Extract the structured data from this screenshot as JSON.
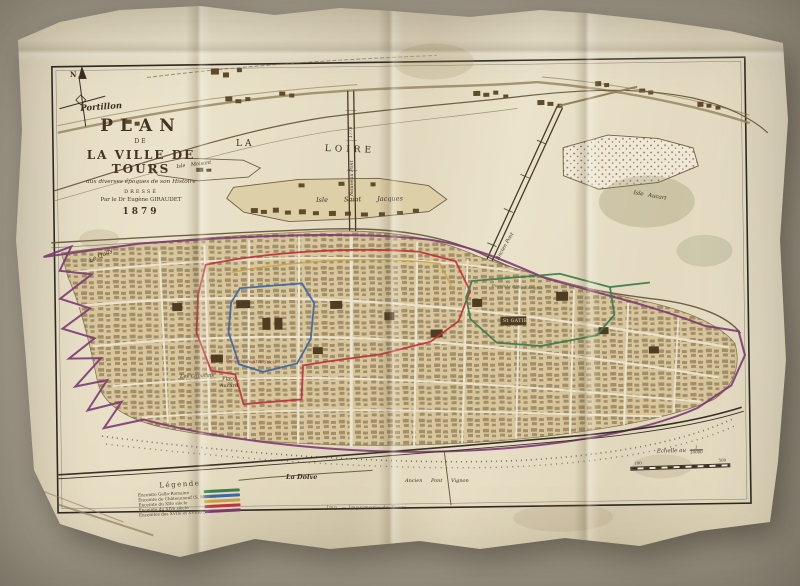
{
  "photo": {
    "backdrop_color": "#b2aa9a",
    "paper_color": "#e8dfc7"
  },
  "map": {
    "title_block": {
      "line1": "PLAN",
      "line2": "DE",
      "line3": "LA VILLE DE TOURS",
      "line4": "aux diverses époques de son Histoire",
      "line5": "DRESSÉ",
      "line6": "Par le Dr Eugène GIRAUDET",
      "line7": "1879"
    },
    "compass": {
      "north": "N"
    },
    "labels": {
      "portillon": "Portillon",
      "la": "LA",
      "loire": "LOIRE",
      "isle_moisant": "Isle Moisant",
      "isle_saint_jacques": "Isle Saint Jacques",
      "isle_aucart": "Isle Aucart",
      "nouveau_pont": "Nouveau Pont",
      "nouveau_pont_date": "1778",
      "ancien_pont": "Ancien Pont",
      "st_gatien": "St GATIEN",
      "les_capucins": "Les Capucins",
      "place_aucard": "Place Aucard",
      "le_quay": "Le Quay",
      "la_dolve": "La Dolve",
      "enceinte_gallo": "Enceinte Gallo-Romaine",
      "enceinte_xiv": "Enceinte du XIVe Siècle",
      "ancien_pont_vignon": "Ancien Pont Vignon"
    },
    "legend": {
      "title": "Légende",
      "entries": [
        {
          "label": "Enceinte Gallo-Romaine",
          "color": "#3e7d4f"
        },
        {
          "label": "Enceinte de Châteauneuf (S. Martin)",
          "color": "#3e68a8"
        },
        {
          "label": "Enceinte du XIIe siècle",
          "color": "#c9a23e"
        },
        {
          "label": "Enceinte du XIVe siècle",
          "color": "#c2333f"
        },
        {
          "label": "Enceintes des XVIIe et XVIIIe S.",
          "color": "#7c3a74"
        }
      ]
    },
    "scale": {
      "label": "Echelle au",
      "ratio_numerator": "1",
      "ratio_denominator": "10000",
      "tick_left": "100",
      "tick_right": "500"
    },
    "imprint": "Imp. — Imprimerie de Tours",
    "colors": {
      "enceinte_gallo_roman": "#3e7d4f",
      "enceinte_chateauneuf": "#3e68a8",
      "enceinte_12e": "#c9a23e",
      "enceinte_14e": "#c2333f",
      "enceinte_17e_18e": "#7c3a74",
      "city_fill": "#d8c69c",
      "building": "#5f4c2b",
      "ink": "#3c2f1f"
    }
  }
}
